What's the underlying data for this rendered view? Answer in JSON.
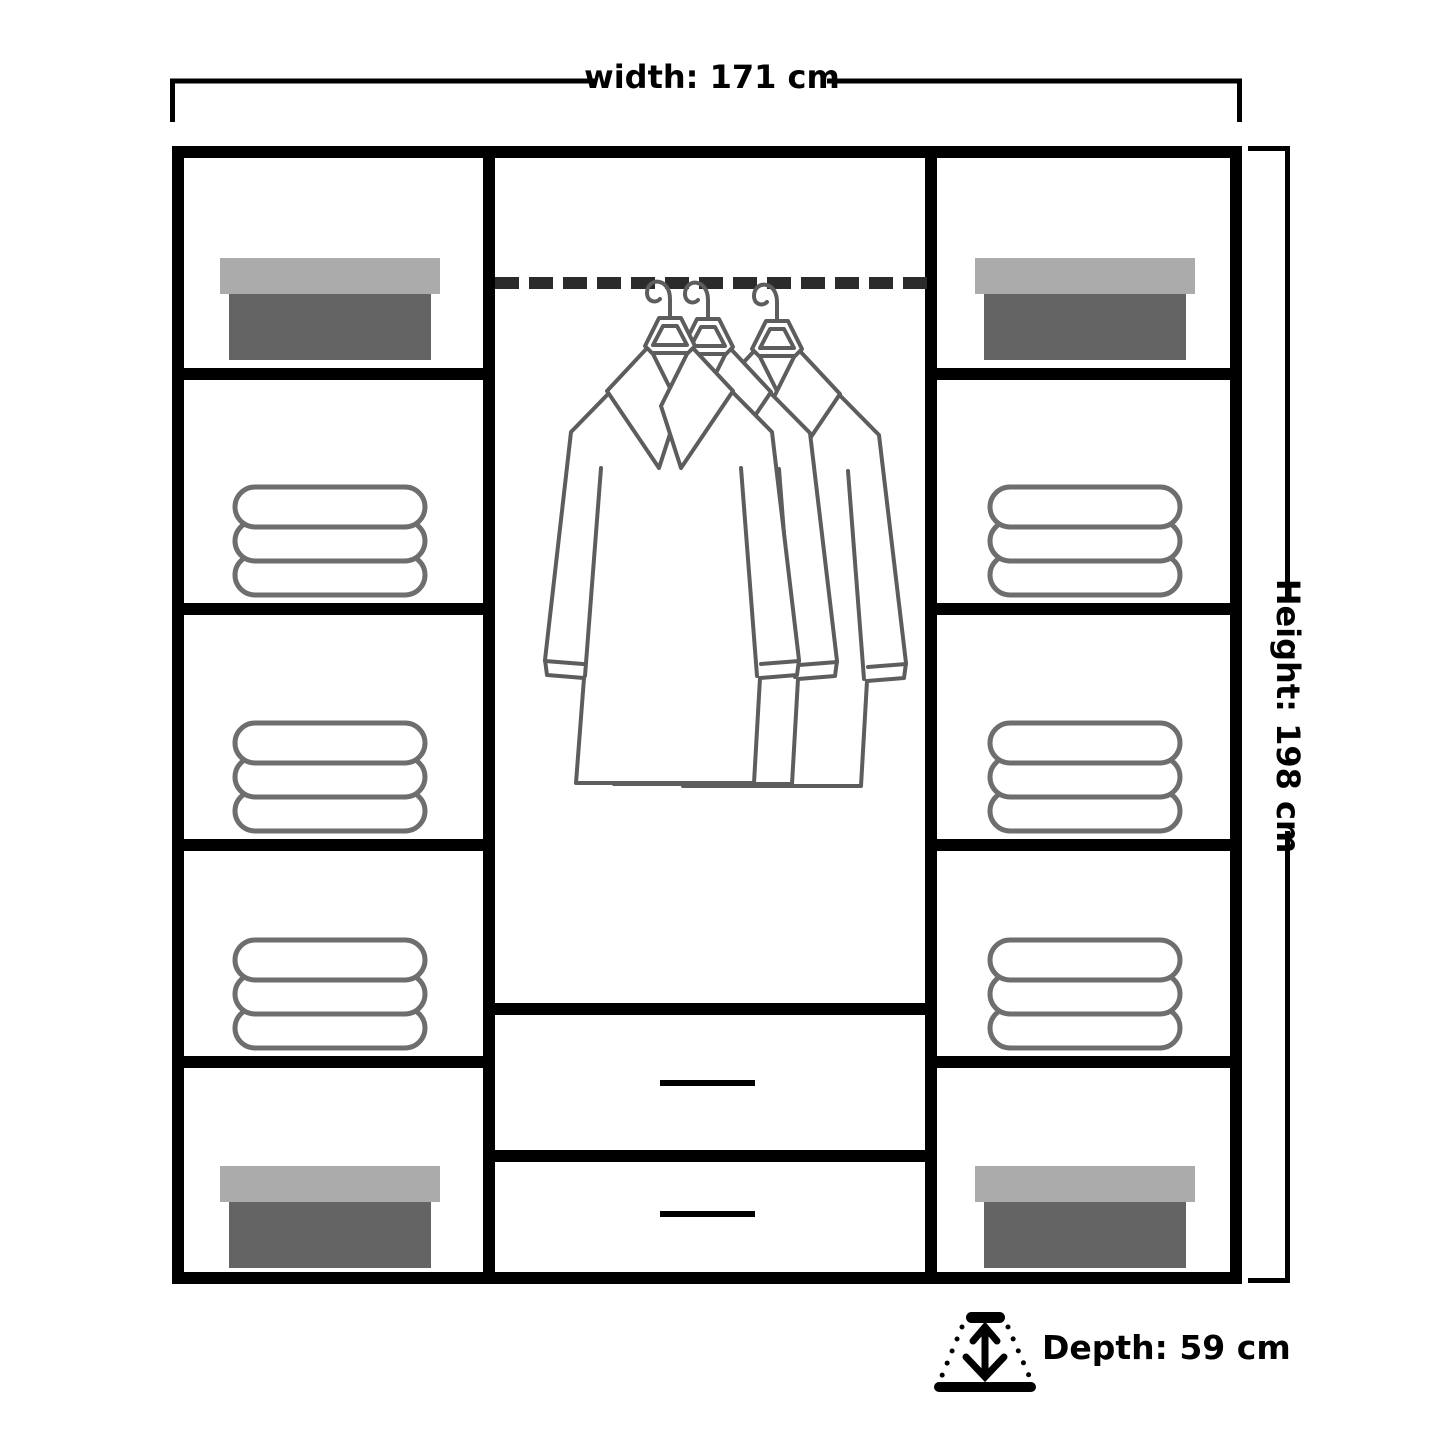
{
  "title": "Wardrobe interior dimensions diagram",
  "labels": {
    "width": "width: 171 cm",
    "height": "Height: 198 cm",
    "depth": "Depth: 59 cm"
  },
  "dimensions": {
    "width_cm": 171,
    "height_cm": 198,
    "depth_cm": 59
  },
  "colors": {
    "background": "#ffffff",
    "frame": "#000000",
    "text": "#000000",
    "rail": "#2b2b2b",
    "outline": "#5d5d5d",
    "towel_outline": "#6e6e6e",
    "box_lid": "#ababab",
    "box_body": "#646464"
  },
  "wardrobe": {
    "left_column_shelves": [
      "storage-box",
      "towel-stack",
      "towel-stack",
      "towel-stack",
      "storage-box"
    ],
    "right_column_shelves": [
      "storage-box",
      "towel-stack",
      "towel-stack",
      "towel-stack",
      "storage-box"
    ],
    "center_section": [
      "hanging-rail",
      "shirts-on-hangers",
      "drawer",
      "drawer"
    ],
    "hanger_count": 3,
    "drawer_count": 2,
    "towels_per_stack": 3
  }
}
